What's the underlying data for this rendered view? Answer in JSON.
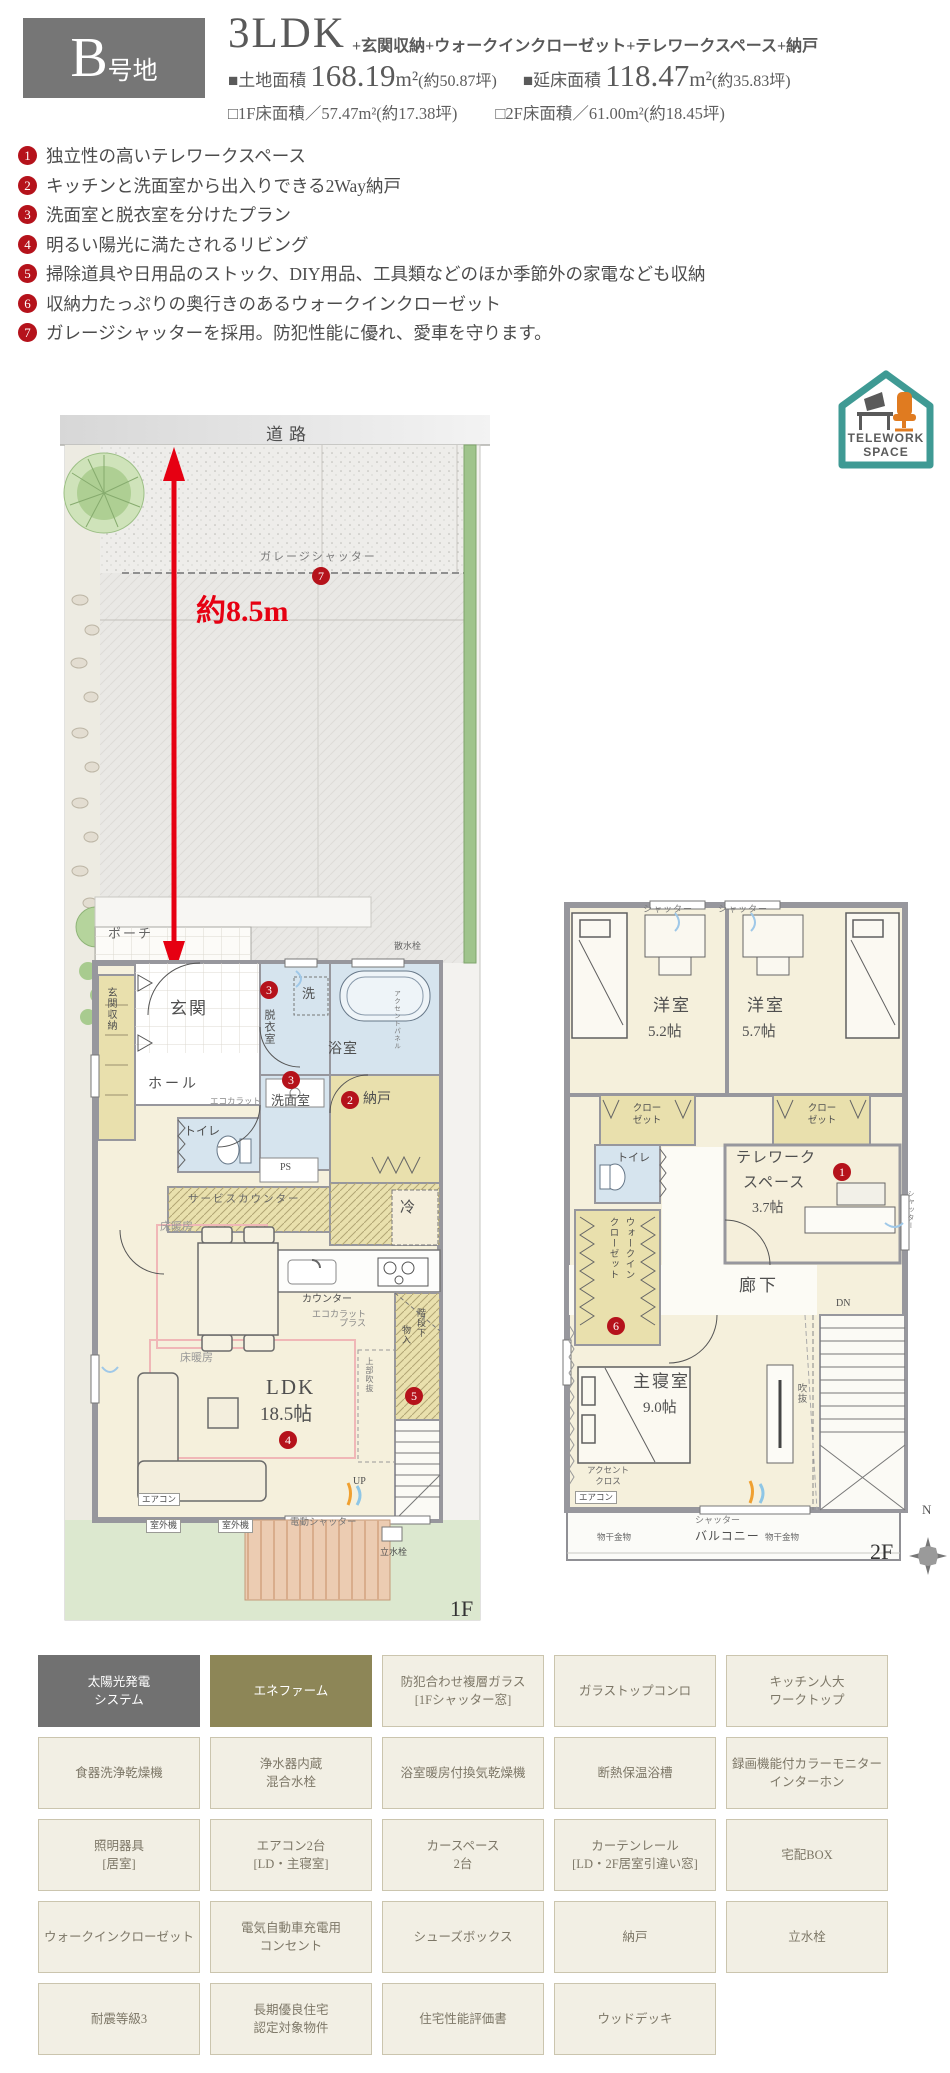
{
  "header": {
    "lot_letter": "B",
    "lot_suffix": "号地",
    "plan": "3LDK",
    "extras": "+玄関収納+ウォークインクローゼット+テレワークスペース+納戸",
    "land_label": "■土地面積",
    "land_num": "168.19",
    "land_unit": "m²",
    "land_tsubo": "(約50.87坪)",
    "gross_label": "■延床面積",
    "gross_num": "118.47",
    "gross_unit": "m²",
    "gross_tsubo": "(約35.83坪)",
    "f1": "□1F床面積／57.47m²(約17.38坪)",
    "f2": "□2F床面積／61.00m²(約18.45坪)"
  },
  "features": [
    {
      "num": "1",
      "text": "独立性の高いテレワークスペース"
    },
    {
      "num": "2",
      "text": "キッチンと洗面室から出入りできる2Way納戸"
    },
    {
      "num": "3",
      "text": "洗面室と脱衣室を分けたプラン"
    },
    {
      "num": "4",
      "text": "明るい陽光に満たされるリビング"
    },
    {
      "num": "5",
      "text": "掃除道具や日用品のストック、DIY用品、工具類などのほか季節外の家電なども収納"
    },
    {
      "num": "6",
      "text": "収納力たっぷりの奥行きのあるウォークインクローゼット"
    },
    {
      "num": "7",
      "text": "ガレージシャッターを採用。防犯性能に優れ、愛車を守ります。"
    }
  ],
  "logo": {
    "line1": "TELEWORK",
    "line2": "SPACE"
  },
  "plan1f": {
    "road": "道路",
    "garage_shutter": "ガレージシャッター",
    "dim": "約8.5m",
    "porch": "ポーチ",
    "sprinkler": "散水栓",
    "entrance_storage": "玄関収納",
    "entrance": "玄関",
    "washer": "洗",
    "dressing_room": "脱衣室",
    "bath": "浴室",
    "accent_panel": "アクセントパネル",
    "hall": "ホール",
    "ecocarat": "エコカラット",
    "washroom": "洗面室",
    "storage": "納戸",
    "toilet": "トイレ",
    "ps": "PS",
    "service_counter": "サービスカウンター",
    "fridge": "冷",
    "counter": "カウンター",
    "ecocarat_plus_1": "エコカラット",
    "ecocarat_plus_2": "プラス",
    "floor_heating": "床暖房",
    "ldk": "LDK",
    "ldk_size": "18.5帖",
    "under_stair_1": "階段下",
    "under_stair_2": "物入",
    "void_upper": "上部吹抜",
    "up": "UP",
    "aircon": "エアコン",
    "outdoor_unit": "室外機",
    "electric_shutter": "電動シャッター",
    "tap": "立水栓",
    "floor": "1F"
  },
  "plan2f": {
    "shutter": "シャッター",
    "room_a": "洋室",
    "room_a_size": "5.2帖",
    "room_b": "洋室",
    "room_b_size": "5.7帖",
    "closet_l1": "クロー",
    "closet_l2": "ゼット",
    "toilet": "トイレ",
    "wic_1": "ウォークイン",
    "wic_2": "クローゼット",
    "telework_1": "テレワーク",
    "telework_2": "スペース",
    "telework_size": "3.7帖",
    "corridor": "廊下",
    "dn": "DN",
    "void": "吹抜",
    "master": "主寝室",
    "master_size": "9.0帖",
    "accent_1": "アクセント",
    "accent_2": "クロス",
    "aircon": "エアコン",
    "balcony": "バルコニー",
    "drying": "物干金物",
    "floor": "2F",
    "north": "N"
  },
  "amenities": {
    "cells": [
      {
        "l1": "太陽光発電",
        "l2": "システム"
      },
      {
        "l1": "エネファーム",
        "l2": ""
      },
      {
        "l1": "防犯合わせ複層ガラス",
        "l2": "[1Fシャッター窓]"
      },
      {
        "l1": "ガラストップコンロ",
        "l2": ""
      },
      {
        "l1": "キッチン人大",
        "l2": "ワークトップ"
      },
      {
        "l1": "食器洗浄乾燥機",
        "l2": ""
      },
      {
        "l1": "浄水器内蔵",
        "l2": "混合水栓"
      },
      {
        "l1": "浴室暖房付換気乾燥機",
        "l2": ""
      },
      {
        "l1": "断熱保温浴槽",
        "l2": ""
      },
      {
        "l1": "録画機能付カラーモニター",
        "l2": "インターホン"
      },
      {
        "l1": "照明器具",
        "l2": "[居室]"
      },
      {
        "l1": "エアコン2台",
        "l2": "[LD・主寝室]"
      },
      {
        "l1": "カースペース",
        "l2": "2台"
      },
      {
        "l1": "カーテンレール",
        "l2": "[LD・2F居室引違い窓]"
      },
      {
        "l1": "宅配BOX",
        "l2": ""
      },
      {
        "l1": "ウォークインクローゼット",
        "l2": ""
      },
      {
        "l1": "電気自動車充電用",
        "l2": "コンセント"
      },
      {
        "l1": "シューズボックス",
        "l2": ""
      },
      {
        "l1": "納戸",
        "l2": ""
      },
      {
        "l1": "立水栓",
        "l2": ""
      },
      {
        "l1": "耐震等級3",
        "l2": ""
      },
      {
        "l1": "長期優良住宅",
        "l2": "認定対象物件"
      },
      {
        "l1": "住宅性能評価書",
        "l2": ""
      },
      {
        "l1": "ウッドデッキ",
        "l2": ""
      },
      {
        "l1": "",
        "l2": ""
      }
    ]
  },
  "colors": {
    "header_gray": "#767676",
    "badge_red": "#b5121b",
    "arrow_red": "#e60012",
    "floor_heating_pink": "#f0b7b7",
    "logo_teal": "#3f9a94",
    "logo_orange": "#e07b20",
    "amenity_olive": "#8d8657",
    "room_cream": "#f5f0dc",
    "wet_blue": "#d6e4ee",
    "storage_khaki": "#e9e0ad"
  }
}
